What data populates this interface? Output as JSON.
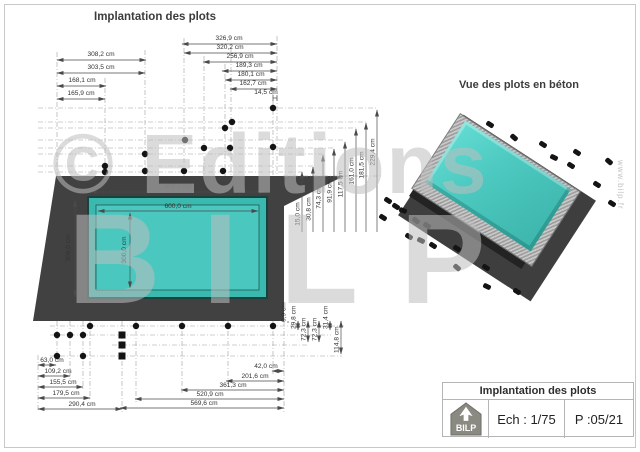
{
  "titles": {
    "plan": "Implantation des plots",
    "view3d": "Vue des plots en béton"
  },
  "watermark": {
    "editions": "© Editions",
    "bilp": "BILP",
    "website": "www.bilp.fr"
  },
  "pool": {
    "outer_width": "609,0 cm",
    "inner_width": "600,0 cm",
    "outer_height": "309,0 cm",
    "inner_height": "300,0 cm"
  },
  "dims": {
    "top_left": [
      "308,2 cm",
      "303,5 cm",
      "168,1 cm",
      "165,9 cm"
    ],
    "top_right": [
      "326,9 cm",
      "320,2 cm",
      "256,9 cm",
      "189,3 cm",
      "180,1 cm",
      "162,7 cm",
      "14,5 cm"
    ],
    "right_vertical": [
      "15,0 cm",
      "30,8 cm",
      "74,3 cm",
      "91,9 cm",
      "117,5 cm",
      "161,0 cm",
      "181,5 cm",
      "229,4 cm"
    ],
    "bottom_offsets": [
      "6,9 cm",
      "29,8 cm",
      "72,3 cm",
      "72,3 cm",
      "31,4 cm",
      "114,8 cm"
    ],
    "bottom_right": [
      "42,0 cm",
      "201,6 cm",
      "361,3 cm",
      "520,9 cm",
      "569,6 cm"
    ],
    "bottom_left": [
      "63,0 cm",
      "109,2 cm",
      "155,5 cm",
      "179,5 cm",
      "290,4 cm"
    ]
  },
  "title_block": {
    "title": "Implantation des plots",
    "scale": "Ech : 1/75",
    "page": "P :05/21",
    "logo": "BILP"
  },
  "colors": {
    "pool_water": "#47c7bd",
    "slab": "#3f3f3f",
    "plots": "#141414",
    "dim_text": "#3a3a3a",
    "watermark": "#c9c9c9"
  }
}
